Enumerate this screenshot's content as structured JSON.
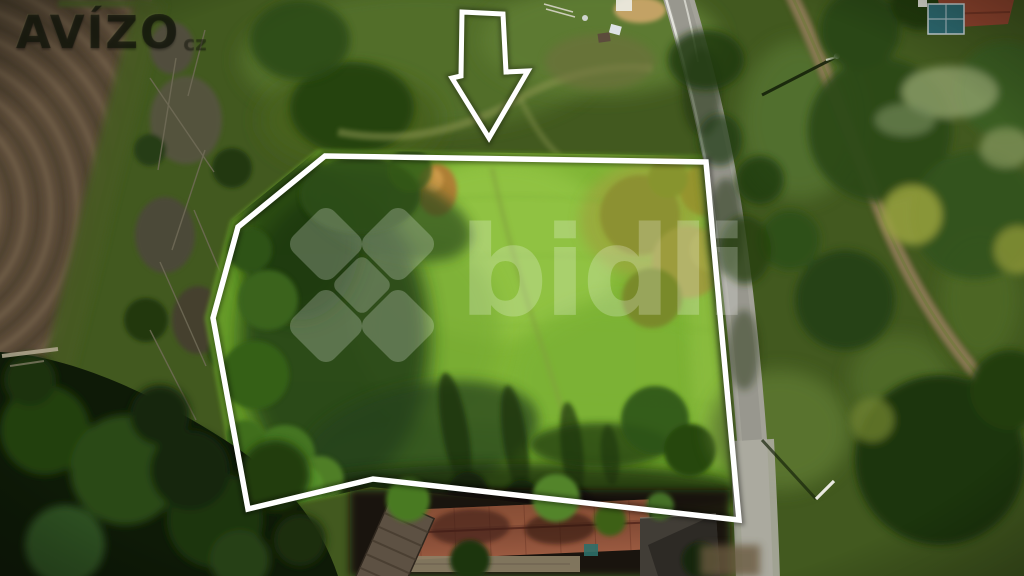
{
  "watermarks": {
    "avizo": {
      "text": "AVÍZO",
      "suffix": "cz",
      "color": "rgba(22,26,14,0.58)"
    },
    "bidli": {
      "text": "bidli",
      "color": "#ffffff"
    }
  },
  "overlay": {
    "outline_color": "#ffffff",
    "plot_outline_points": "325,156 706,162 739,520 373,479 248,509 213,318 238,227",
    "arrow_points": "462,12 503,14 506,72 528,71 489,138 452,78 461,76"
  },
  "scene": {
    "type": "aerial-photo-of-land-plot",
    "palette": {
      "meadow_green": "#7cb032",
      "forest_dark_green": "#16280b",
      "plowed_field_brown": "#5a4a38",
      "road_gray": "#a3a298",
      "dirt_path_brown": "#8d7c57",
      "roof_red": "#8a4a36",
      "autumn_yellow": "#9aa23e"
    }
  }
}
